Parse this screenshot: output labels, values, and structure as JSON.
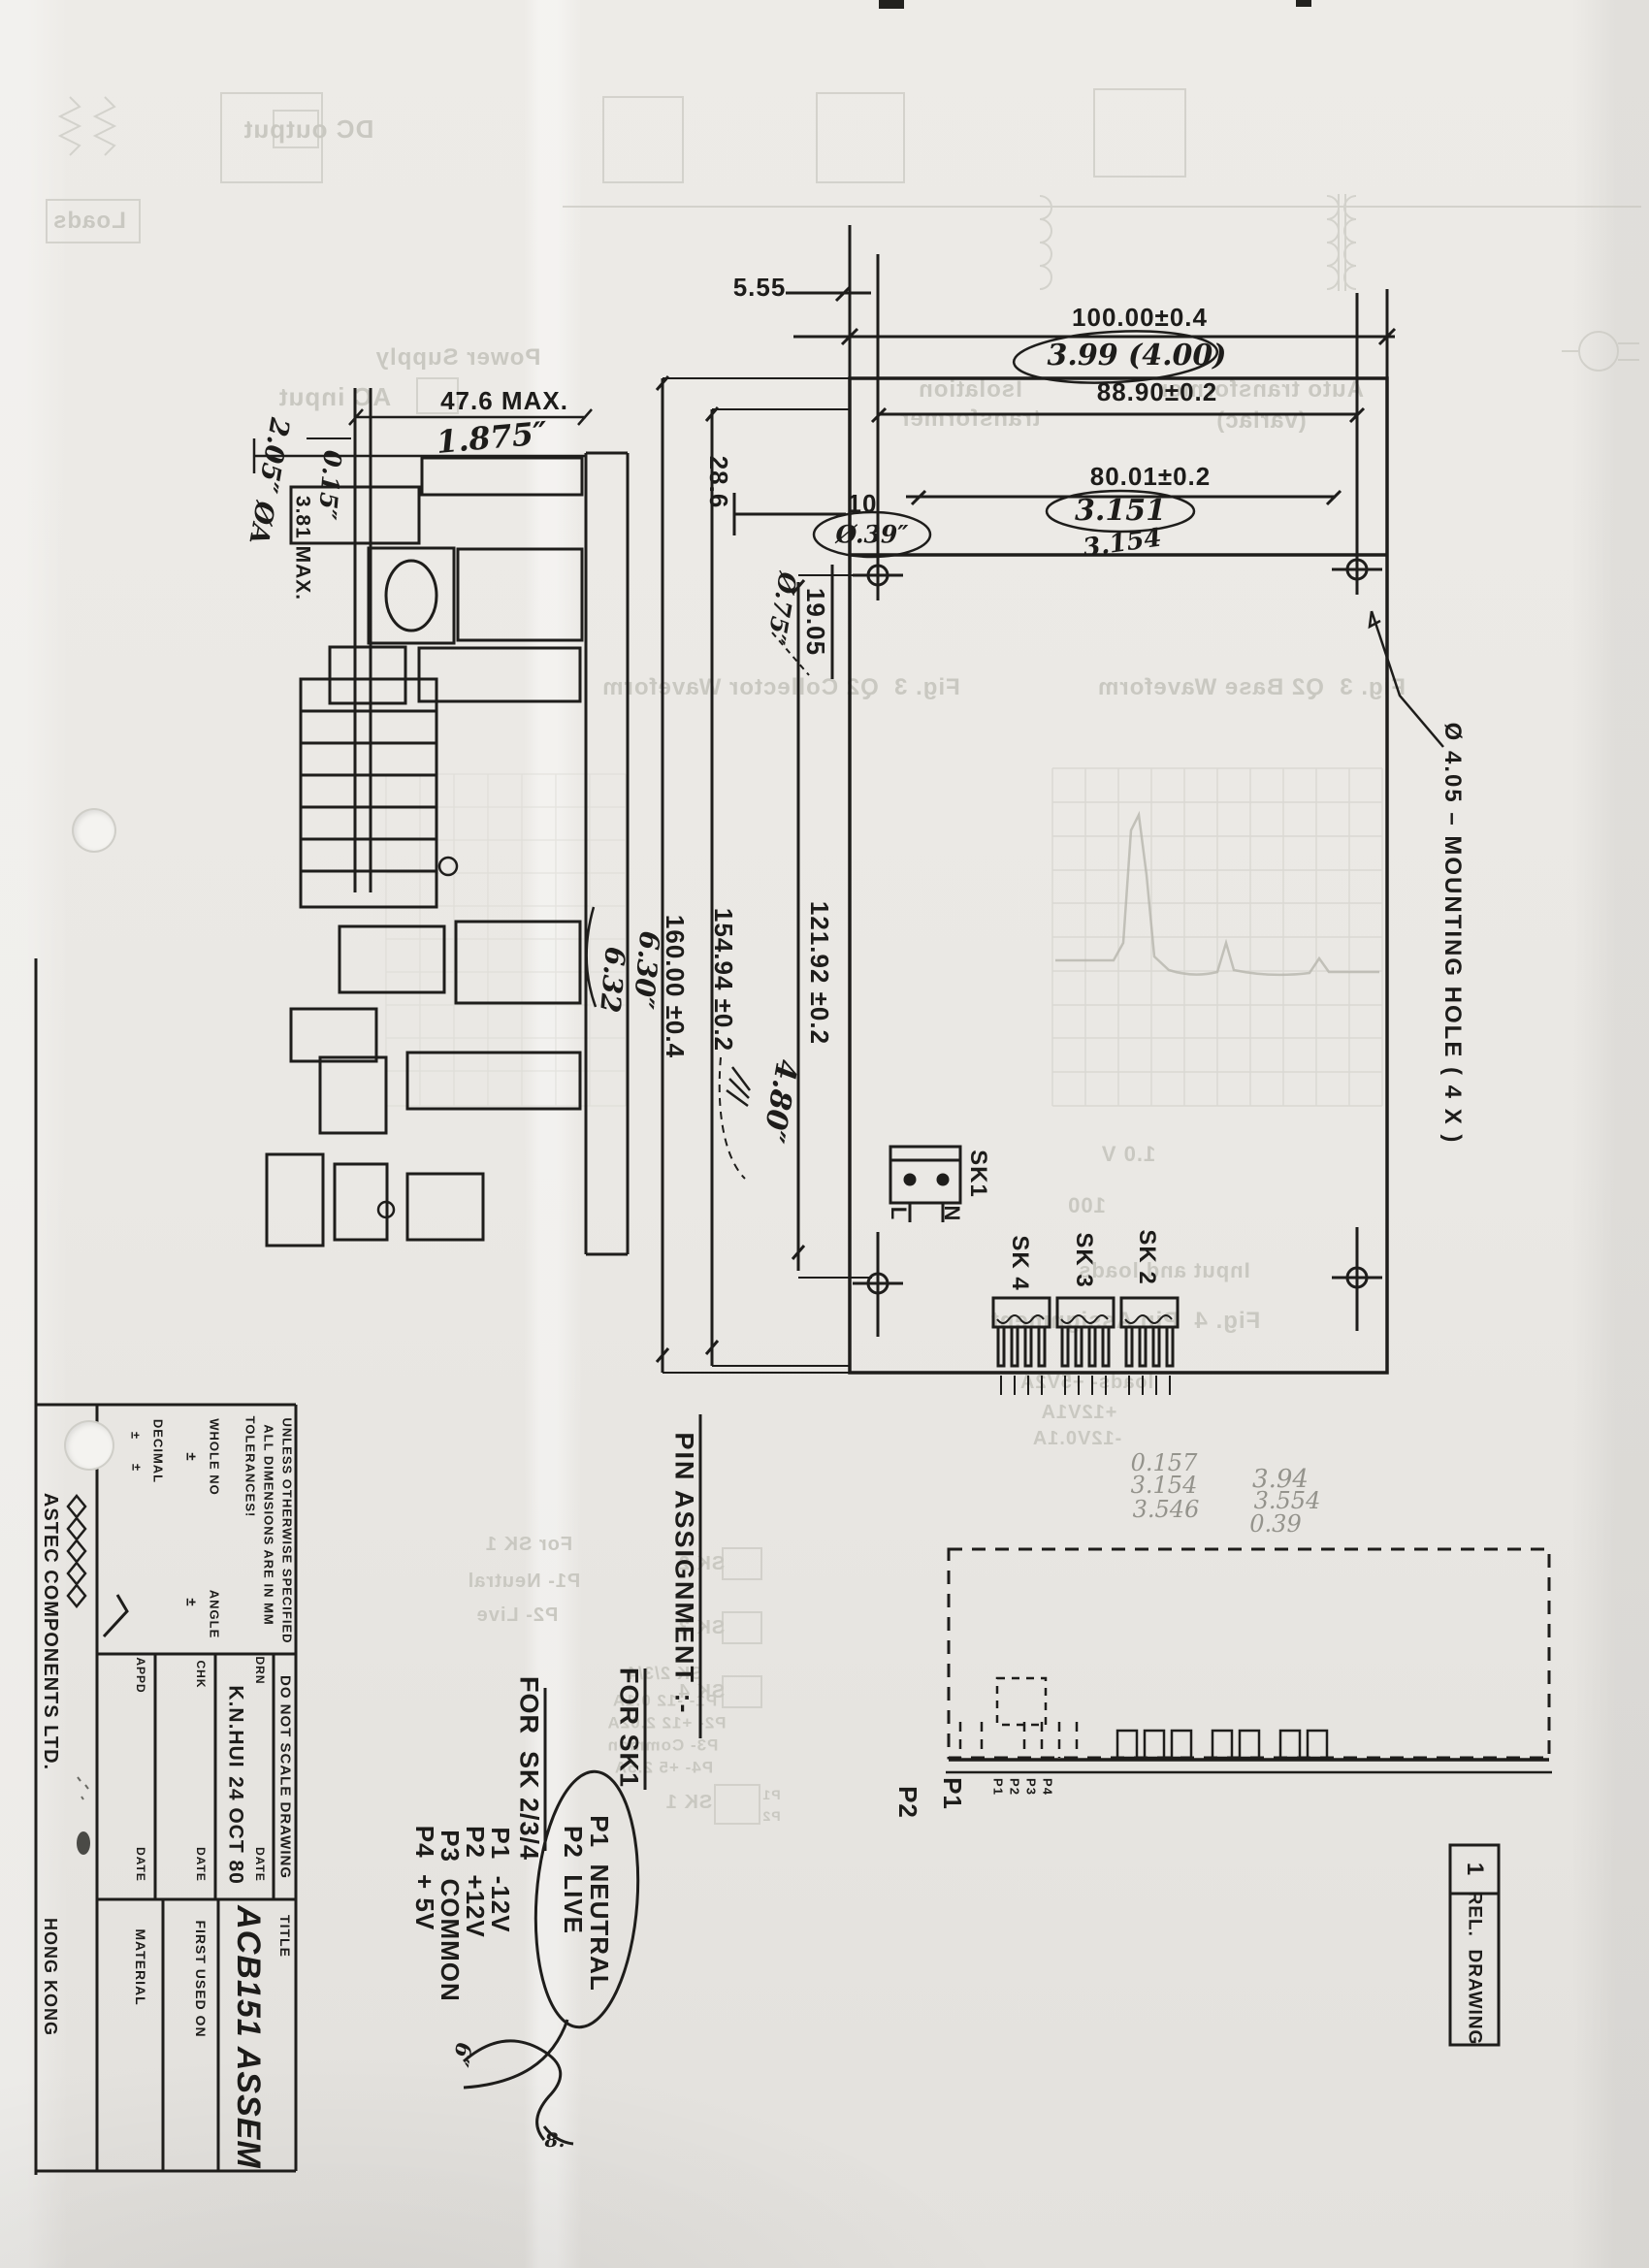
{
  "top_view": {
    "dim_width": "100.00±0.4",
    "hw_width_in": "3.99 (4.00)",
    "dim_holes_x": "88.90±0.2",
    "dim_8001": "80.01±0.2",
    "hw_3151": "3.151",
    "hw_3154": "3.154",
    "dim_555": "5.55",
    "dim_286": "28.6",
    "dim_10": "10",
    "hw_039": "Ø.39″",
    "dim_1905": "19.05",
    "hw_075": "Ø.75″",
    "mounting_note": "Ø 4.05 – MOUNTING HOLE ( 4 X )",
    "dim_12192": "121.92 ±0.2",
    "dim_15494": "154.94 ±0.2",
    "dim_16000": "160.00 ±0.4",
    "hw_630": "6.30″",
    "hw_632": "6.32",
    "hw_480": "4.80″",
    "sk1": "SK1",
    "sk1_l": "L",
    "sk1_n": "N",
    "sk2": "SK 2",
    "sk3": "SK 3",
    "sk4": "SK 4"
  },
  "side_view": {
    "dim_476": "47.6 MAX.",
    "hw_1875": "1.875″",
    "hw_015": "0.15″",
    "dim_381": "3.81 MAX.",
    "hw_205": "2.05″ ØA"
  },
  "bottom_view": {
    "p2": "P2",
    "p1": "P1",
    "pins": [
      "P1",
      "P2",
      "P3",
      "P4"
    ]
  },
  "pencil": {
    "left": [
      "0.157",
      "3.154",
      "3.546"
    ],
    "right": [
      "3.94",
      "3.554",
      "0.39"
    ],
    "hw_6": "6″",
    "hw_8": "8."
  },
  "pin_assignment": {
    "title": "PIN ASSIGNMENT :-",
    "sk1_header": "FOR SK1",
    "sk1_p1": "P1  NEUTRAL",
    "sk1_p2": "P2  LIVE",
    "sk234_header": "FOR  SK 2/3/4",
    "p1": "P1  -12V",
    "p2": "P2  +12V",
    "p3": "P3  COMMON",
    "p4": "P4  + 5V"
  },
  "title_block": {
    "company": "ASTEC COMPONENTS LTD.",
    "city": "HONG KONG",
    "spec1": "UNLESS OTHERWISE SPECIFIED",
    "spec2": "ALL DIMENSIONS ARE IN MM",
    "spec3": "TOLERANCES!",
    "whole_no": "WHOLE NO",
    "decimal": "DECIMAL",
    "angle": "ANGLE",
    "pm": "±",
    "do_not_scale": "DO NOT SCALE DRAWING",
    "drn": "DRN",
    "chk": "CHK",
    "app": "APPD",
    "date": "DATE",
    "drn_name": "K.N.HUI",
    "drn_date": "24 OCT 80",
    "title_label": "TITLE",
    "title_value": "ACB151 ASSEM",
    "first_used": "FIRST USED ON",
    "material": "MATERIAL"
  },
  "rev": {
    "number": "1",
    "label": "REL.  DRAWING"
  },
  "bleed": {
    "dc_output": "DC output",
    "loads": "Loads",
    "ac_input": "AC input",
    "power_supply": "Power Supply",
    "iso1": "Isolation",
    "iso2": "transformer",
    "auto1": "Auto transformer",
    "auto2": "(variac)",
    "fig_left": "Fig. 3  Q2 Collector Waveform",
    "fig_right": "Fig. 3  Q2 Base Waveform",
    "v_div": "1.0 V",
    "t_div": "100",
    "input_loads": "Input and loads",
    "fig4": "Fig. 4  Pin Assignment",
    "loads1": "loads- +5V2A",
    "loads2": "+12V1A",
    "loads3": "-12V0.1A",
    "sk2": "SK 2",
    "sk3": "SK 3",
    "sk4": "SK 4",
    "sk1": "SK 1",
    "p1": "P1",
    "p2": "P2",
    "fsk1": "For SK 1",
    "fp1": "P1- Neutral",
    "fp2": "P2- Live",
    "gsk": "SK 2/3/4",
    "g1": "P1- -12 0.1A",
    "g2": "P2- +12 2.02A",
    "g3": "P3- Common",
    "g4": "P4- +5 2.5A"
  }
}
